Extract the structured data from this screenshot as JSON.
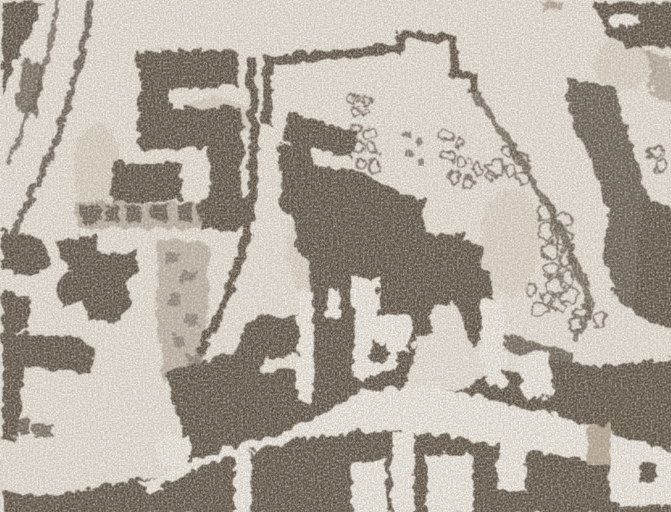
{
  "meta": {
    "kind": "scanned-historical-town-plan-fragment",
    "visible_text": []
  },
  "palette": {
    "background": "#f3efe6",
    "paper": "#fbf9f3",
    "ink_dark": "#4d4236",
    "ink_mid": "#8a7a66",
    "ink_light": "#cdbfa9",
    "courtyard": "#b7a893"
  },
  "regions": {
    "top_left": "curved-road-and-riverbank",
    "left": "building-cluster-and-orchard-row",
    "center": "large-building-block-with-white-court",
    "right": "garden-plots-with-tree-symbols",
    "bottom": "street-with-building-band-and-courtyards"
  }
}
